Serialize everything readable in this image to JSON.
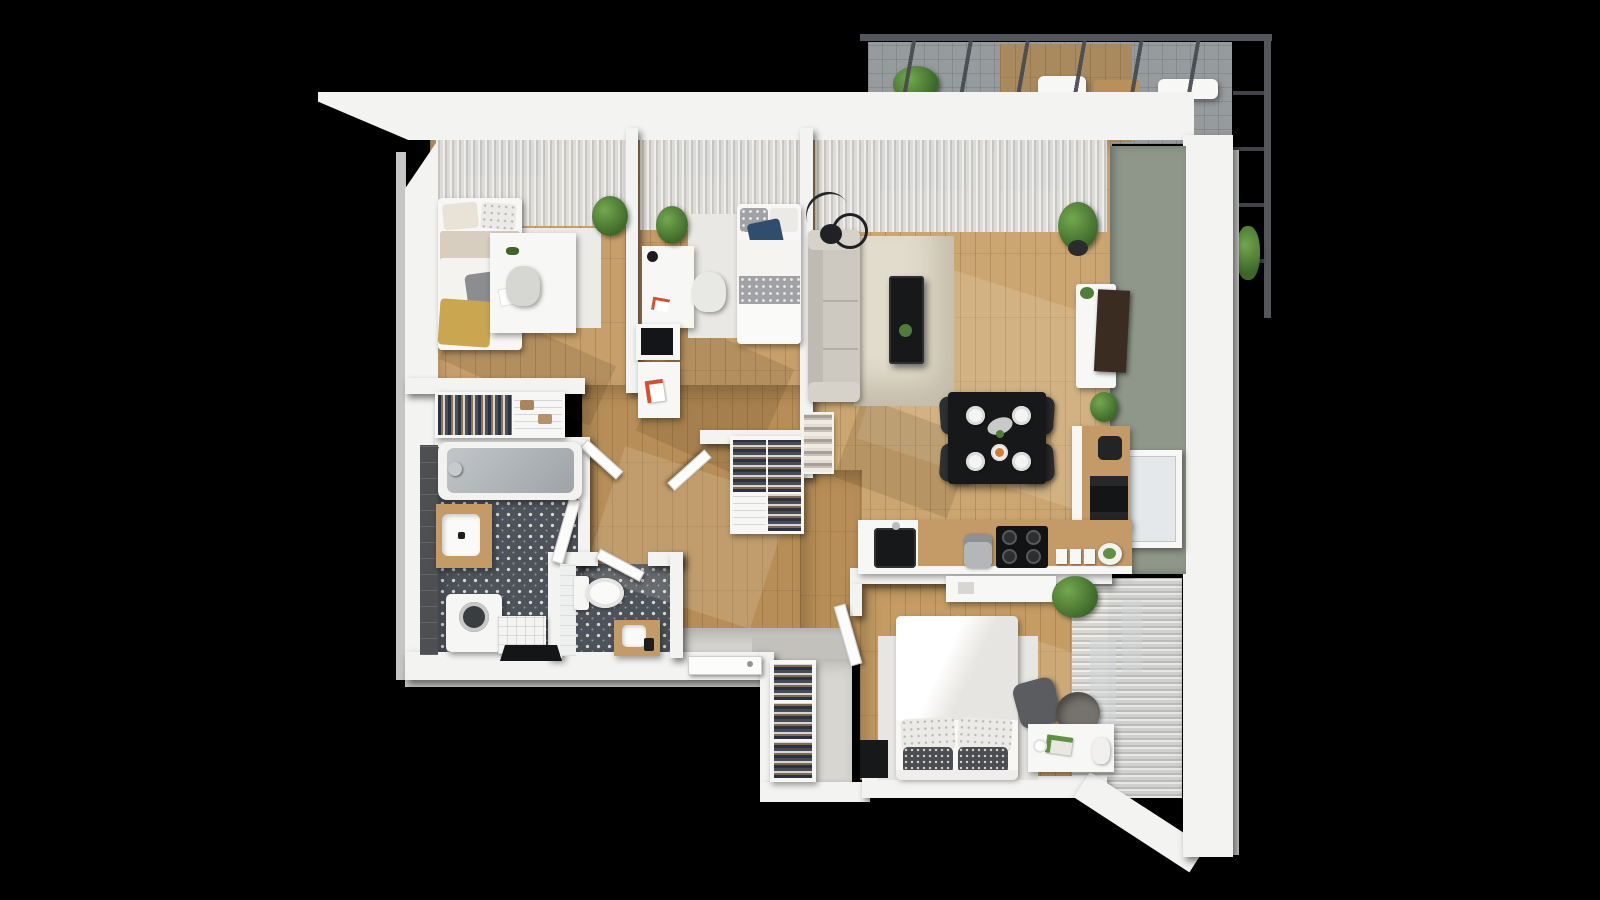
{
  "scene": {
    "kind": "3d-top-down-floor-plan-render",
    "background": "#000000",
    "rooms": [
      {
        "id": "bedroom-1",
        "area": "top-left",
        "furniture": [
          "single bed",
          "desk",
          "chair",
          "light rug",
          "potted plant",
          "window curtains"
        ]
      },
      {
        "id": "bedroom-2",
        "area": "top-center",
        "furniture": [
          "single bed with navy pillow",
          "desk with lamp",
          "desk chair",
          "light rug",
          "wall shelf boxes",
          "potted plant",
          "window curtains"
        ]
      },
      {
        "id": "living-room",
        "area": "top-right",
        "furniture": [
          "fabric sofa",
          "cream rug",
          "black coffee table",
          "arc floor lamp",
          "tv sideboard",
          "leaning tv",
          "potted plants",
          "window curtains",
          "sage accent wall",
          "window"
        ]
      },
      {
        "id": "dining-area",
        "area": "center-right",
        "furniture": [
          "black dining table",
          "four dark chairs",
          "four place settings",
          "serving platter",
          "food dish"
        ]
      },
      {
        "id": "kitchen",
        "area": "right",
        "furniture": [
          "l-shaped counter",
          "black sink",
          "coffee grinder",
          "four-burner cooktop",
          "canisters",
          "fruit bowl",
          "oven column",
          "coffee machine"
        ]
      },
      {
        "id": "hallway",
        "area": "center",
        "furniture": [
          "open wardrobe with clothes",
          "shelf unit",
          "towel shelf",
          "interior doors"
        ]
      },
      {
        "id": "bathroom",
        "area": "bottom-left",
        "furniture": [
          "bathtub",
          "wood vanity with sink",
          "washing machine",
          "tiled bench",
          "open closet with clothes",
          "patterned tile floor",
          "dark tiled wall"
        ]
      },
      {
        "id": "wc",
        "area": "bottom-left",
        "furniture": [
          "toilet",
          "small wood vanity",
          "white tiled wall",
          "patterned tile floor"
        ]
      },
      {
        "id": "entry",
        "area": "bottom-center",
        "furniture": [
          "entrance door",
          "doormat",
          "coat wardrobe with clothes"
        ]
      },
      {
        "id": "bedroom-3",
        "area": "bottom-right",
        "furniture": [
          "double bed with patterned pillows",
          "desk with lamp and book",
          "office chair",
          "pet bed",
          "black floor mat",
          "curtained window wall"
        ]
      },
      {
        "id": "balcony",
        "area": "top-right-outside",
        "furniture": [
          "glass roof with dark beams",
          "tiled floor",
          "wood deck",
          "plants",
          "white loungers"
        ]
      }
    ]
  },
  "colors": {
    "bg": "#000000",
    "wall": "#f3f3f1",
    "wallSide": "#c6c6c4",
    "wood": "#c79f6a",
    "woodDark": "#b78e57",
    "woodLiving": "#cba671",
    "entry": "#d8d6d1",
    "tile": "#4e535b",
    "tileDot": "#d9d9d7",
    "green": "#8f978a",
    "black": "#17181a",
    "chairDark": "#2e3032",
    "sofa": "#cdc9c1",
    "rug": "#e2dccd",
    "bed": "#f8f7f5",
    "navy": "#2f4e6e",
    "mustard": "#c9a64f",
    "woodTop": "#c49a66",
    "tv": "#3a2c20",
    "frame": "#53565a"
  }
}
